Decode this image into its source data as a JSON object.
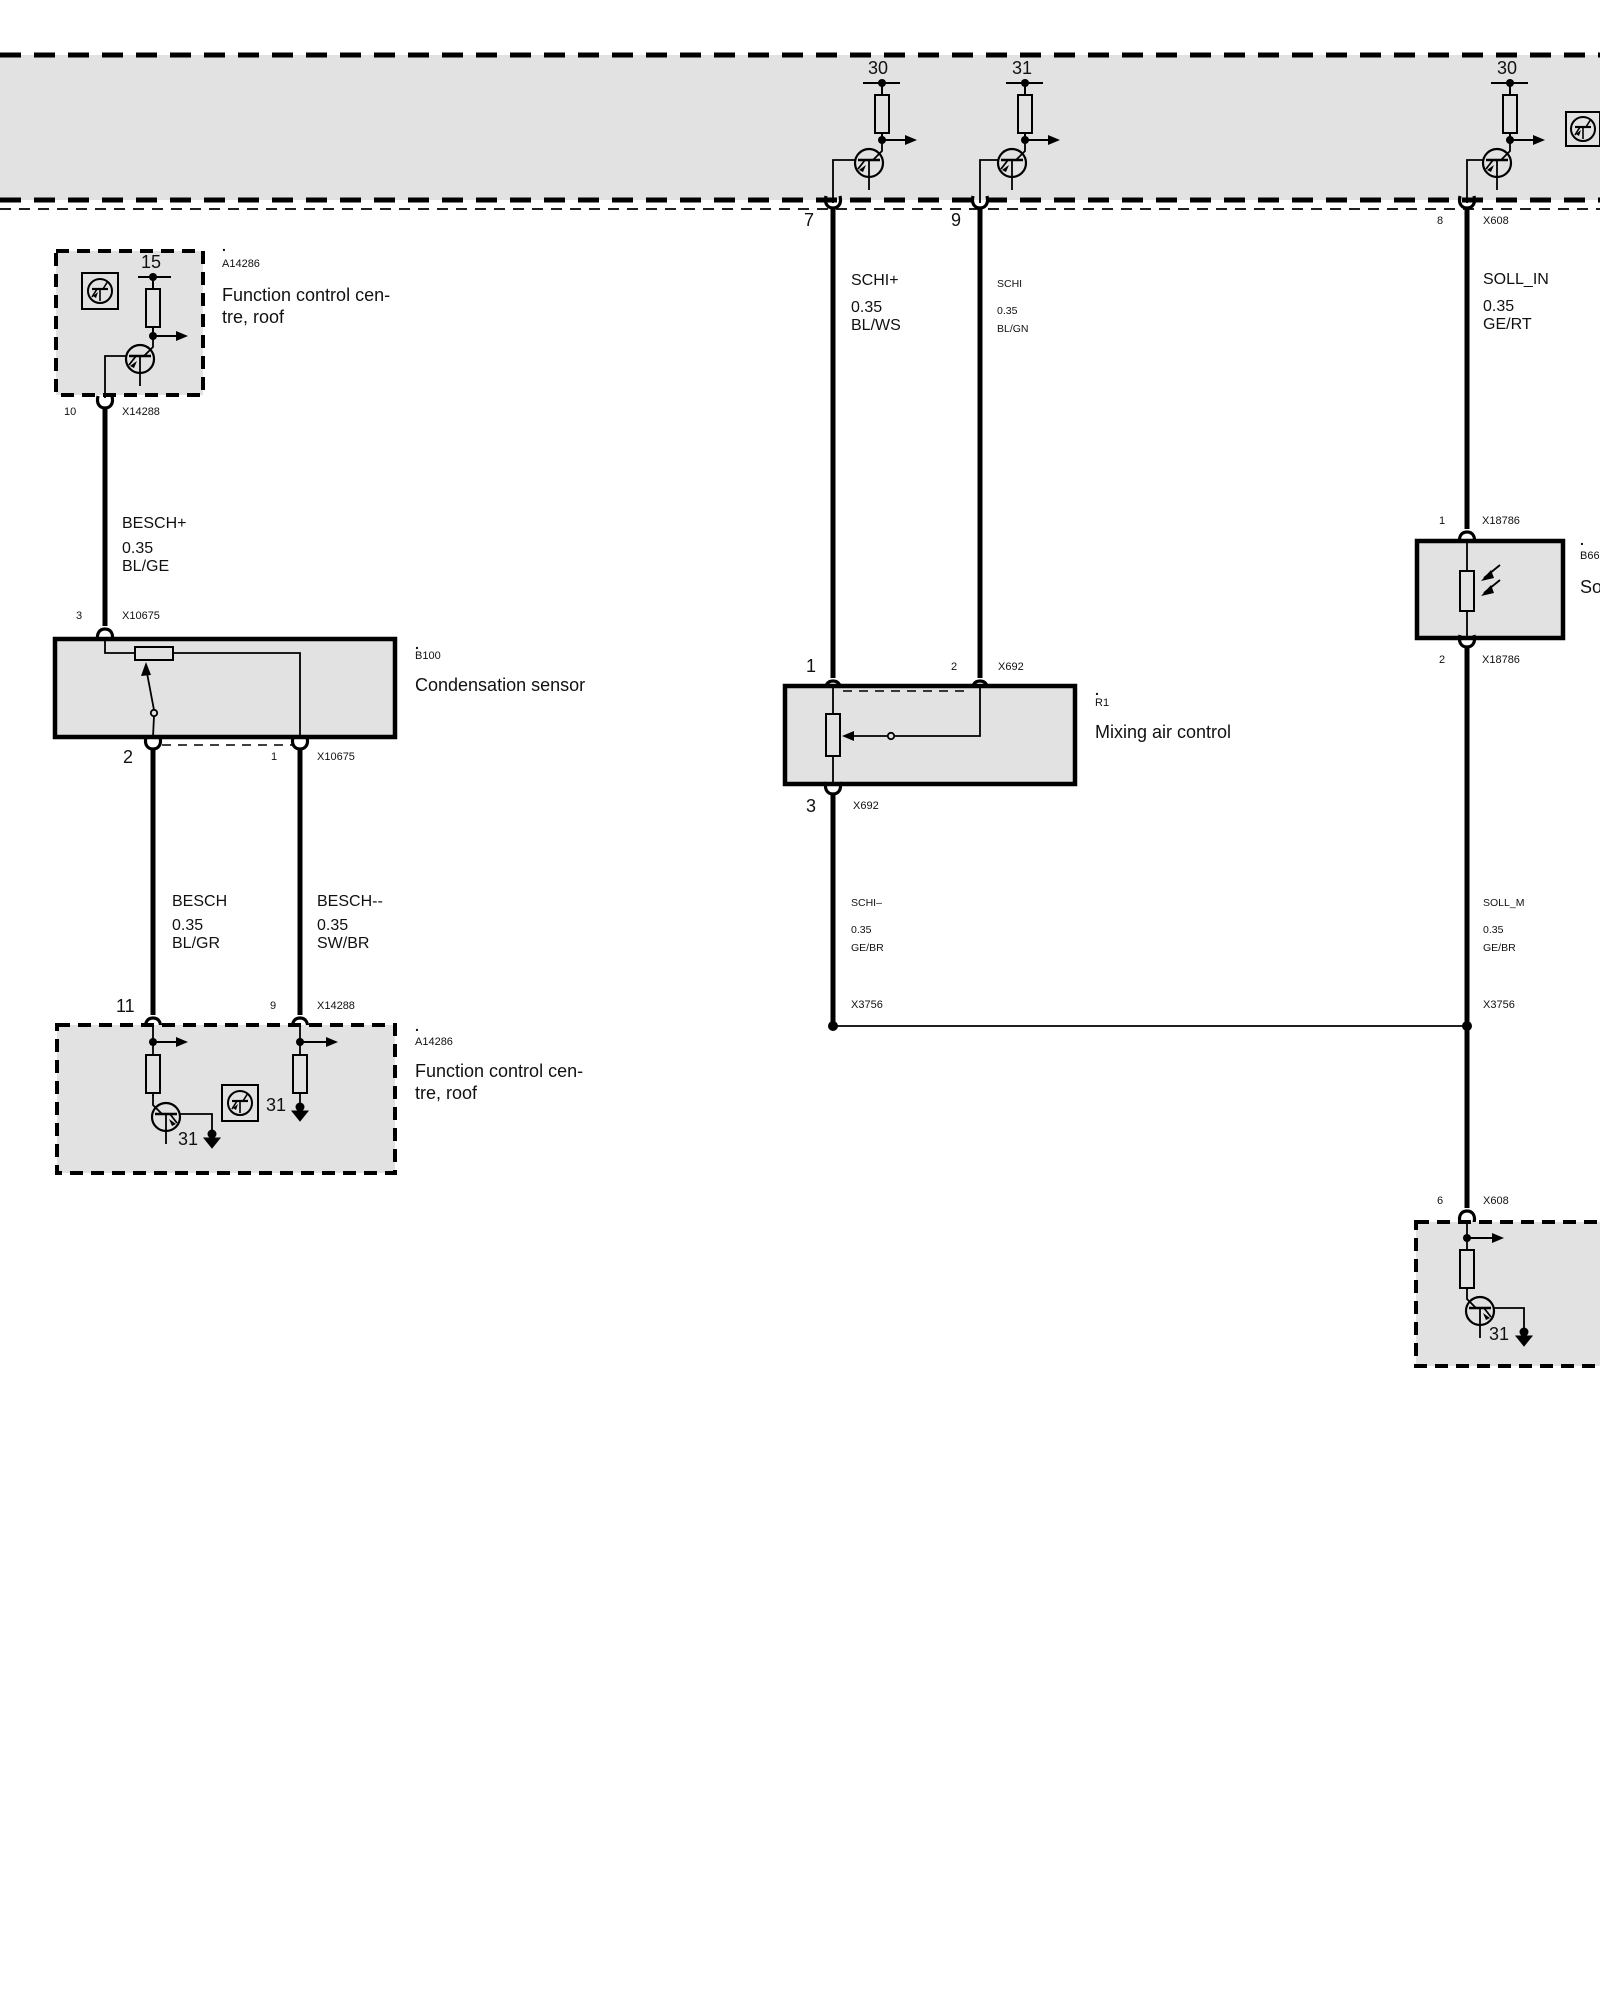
{
  "rail": {
    "fuse30_left": "30",
    "fuse31": "31",
    "fuse30_right": "30"
  },
  "fcc_top": {
    "pin": "15",
    "dot": ".",
    "ref": "A14286",
    "title": "Function control cen-\ntre, roof",
    "pin_out": "10",
    "conn_out": "X14288"
  },
  "w_besch_p": {
    "name": "BESCH+",
    "gauge": "0.35",
    "color": "BL/GE"
  },
  "cond": {
    "pin_in": "3",
    "conn_in": "X10675",
    "dot": ".",
    "ref": "B100",
    "name": "Condensation sensor",
    "pin_left": "2",
    "pin_right": "1",
    "conn_out": "X10675"
  },
  "w_besch": {
    "name": "BESCH",
    "gauge": "0.35",
    "color": "BL/GR"
  },
  "w_besch_m": {
    "name": "BESCH--",
    "gauge": "0.35",
    "color": "SW/BR"
  },
  "fcc_bot": {
    "pin_left": "11",
    "pin_right": "9",
    "conn": "X14288",
    "dot": ".",
    "ref": "A14286",
    "title": "Function control cen-\ntre, roof",
    "gnd_label": "31",
    "icon_label": "31"
  },
  "mid": {
    "pin7": "7",
    "pin9": "9"
  },
  "w_schi_p": {
    "name": "SCHI+",
    "gauge": "0.35",
    "color": "BL/WS"
  },
  "w_schi": {
    "name": "SCHI",
    "gauge": "0.35",
    "color": "BL/GN"
  },
  "mix": {
    "pin1": "1",
    "pin2": "2",
    "conn_top": "X692",
    "dot": ".",
    "ref": "R1",
    "name": "Mixing air control",
    "pin3": "3",
    "conn_bot": "X692"
  },
  "w_schi_m": {
    "name": "SCHI–",
    "gauge": "0.35",
    "color": "GE/BR"
  },
  "junction": {
    "conn_left": "X3756",
    "conn_right": "X3756"
  },
  "right": {
    "pin8": "8",
    "conn8": "X608",
    "pin6": "6",
    "conn6": "X608",
    "gnd_label": "31"
  },
  "w_soll_in": {
    "name": "SOLL_IN",
    "gauge": "0.35",
    "color": "GE/RT"
  },
  "solar": {
    "pin1": "1",
    "conn1": "X18786",
    "pin2": "2",
    "conn2": "X18786",
    "dot": ".",
    "ref": "B66",
    "name_partial": "So"
  },
  "w_soll_m": {
    "name": "SOLL_M",
    "gauge": "0.35",
    "color": "GE/BR"
  },
  "colors": {
    "band_fill": "#e2e2e2",
    "line": "#000000"
  }
}
